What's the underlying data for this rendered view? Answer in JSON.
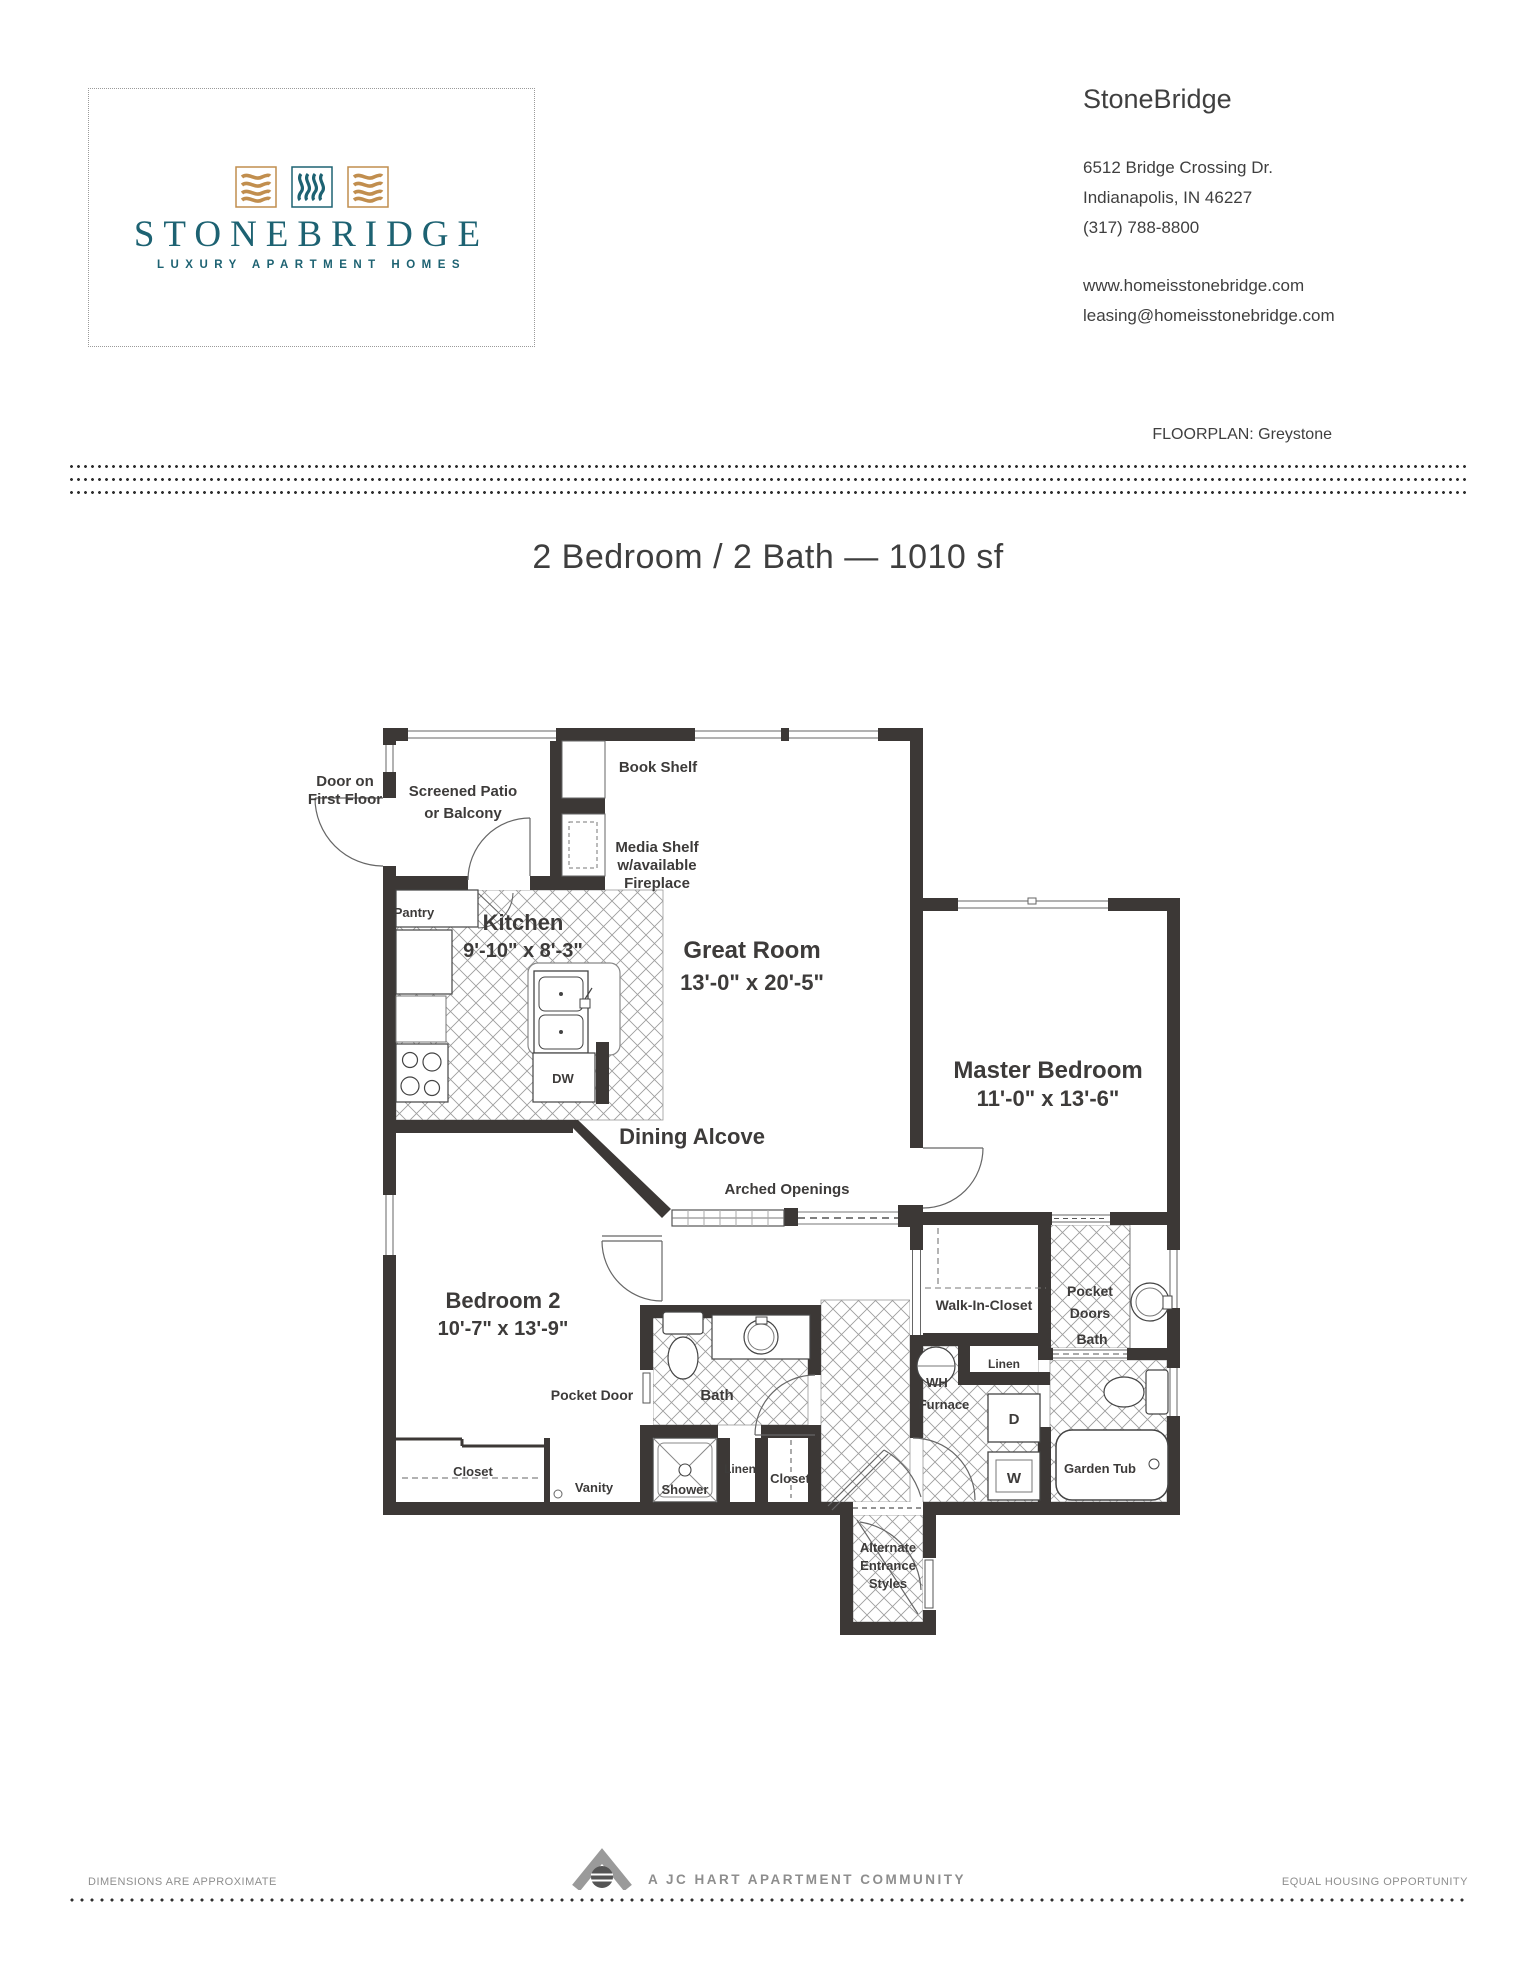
{
  "header": {
    "logo": {
      "wordmark": "STONEBRIDGE",
      "tagline": "LUXURY APARTMENT HOMES"
    },
    "contact": {
      "name": "StoneBridge",
      "address_line1": "6512 Bridge Crossing Dr.",
      "address_line2": "Indianapolis, IN 46227",
      "phone": "(317) 788-8800",
      "website": "www.homeisstonebridge.com",
      "email": "leasing@homeisstonebridge.com"
    },
    "floorplan_label": "FLOORPLAN: Greystone"
  },
  "title": "2 Bedroom / 2 Bath — 1010 sf",
  "plan": {
    "labels": {
      "door_note_1": "Door on",
      "door_note_2": "First Floor",
      "screened_patio_1": "Screened Patio",
      "screened_patio_2": "or Balcony",
      "book_shelf": "Book Shelf",
      "media_shelf_1": "Media Shelf",
      "media_shelf_2": "w/available",
      "media_shelf_3": "Fireplace",
      "pantry": "Pantry",
      "kitchen_1": "Kitchen",
      "kitchen_2": "9'-10\" x 8'-3\"",
      "great_room_1": "Great Room",
      "great_room_2": "13'-0\" x 20'-5\"",
      "master_1": "Master Bedroom",
      "master_2": "11'-0\" x 13'-6\"",
      "dining_alcove": "Dining Alcove",
      "arched_openings": "Arched Openings",
      "bedroom2_1": "Bedroom 2",
      "bedroom2_2": "10'-7\" x 13'-9\"",
      "dw": "DW",
      "pocket_door": "Pocket Door",
      "bath_hall": "Bath",
      "walk_in_closet": "Walk-In-Closet",
      "pocket_doors_1": "Pocket",
      "pocket_doors_2": "Doors",
      "bath_master": "Bath",
      "linen_master": "Linen",
      "wh": "WH",
      "furnace": "Furnace",
      "dryer": "D",
      "washer": "W",
      "garden_tub": "Garden Tub",
      "closet_bedroom2": "Closet",
      "vanity": "Vanity",
      "shower": "Shower",
      "linen_hall": "Linen",
      "closet_hall": "Closet",
      "alt_entrance_1": "Alternate",
      "alt_entrance_2": "Entrance",
      "alt_entrance_3": "Styles"
    }
  },
  "footer": {
    "left": "DIMENSIONS ARE APPROXIMATE",
    "center": "A JC HART APARTMENT COMMUNITY",
    "right": "EQUAL HOUSING OPPORTUNITY"
  },
  "colors": {
    "teal": "#1d6272",
    "gold": "#c18e4e",
    "wall": "#3c3836",
    "muted_gray": "#8e8e8e"
  }
}
